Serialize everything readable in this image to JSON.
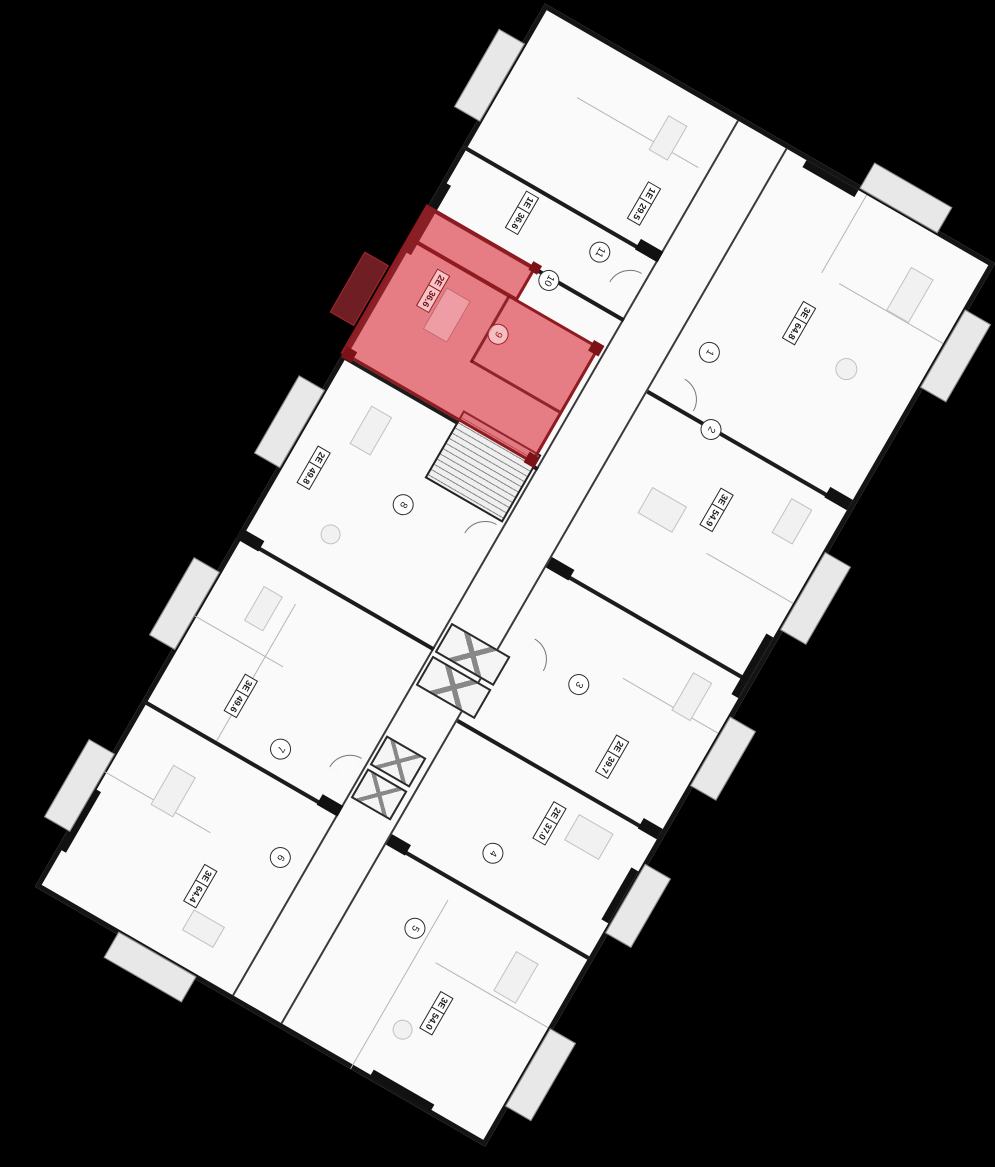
{
  "plan": {
    "description": "floor-plan-with-selected-apartment",
    "selected_unit": {
      "number": "9",
      "type": "2E",
      "area": "36.6"
    },
    "units": [
      {
        "number": "1",
        "type": "3E",
        "area": "64.8"
      },
      {
        "number": "2",
        "type": "3E",
        "area": "54.9"
      },
      {
        "number": "3",
        "type": "2E",
        "area": "39.7"
      },
      {
        "number": "4",
        "type": "2E",
        "area": "37.0"
      },
      {
        "number": "5",
        "type": "3E",
        "area": "54.0"
      },
      {
        "number": "6",
        "type": "3E",
        "area": "64.4"
      },
      {
        "number": "7",
        "type": "3E",
        "area": "49.6"
      },
      {
        "number": "8",
        "type": "2E",
        "area": "49.8"
      },
      {
        "number": "9",
        "type": "2E",
        "area": "36.6",
        "selected": true
      },
      {
        "number": "10",
        "type": "1E",
        "area": "36.6"
      },
      {
        "number": "11",
        "type": "1E",
        "area": "29.5"
      }
    ],
    "colors": {
      "background": "#000000",
      "floor": "#fbfafa",
      "walls": "#141414",
      "highlight": "#db2a35",
      "highlight_dark": "#8e1b20"
    }
  }
}
